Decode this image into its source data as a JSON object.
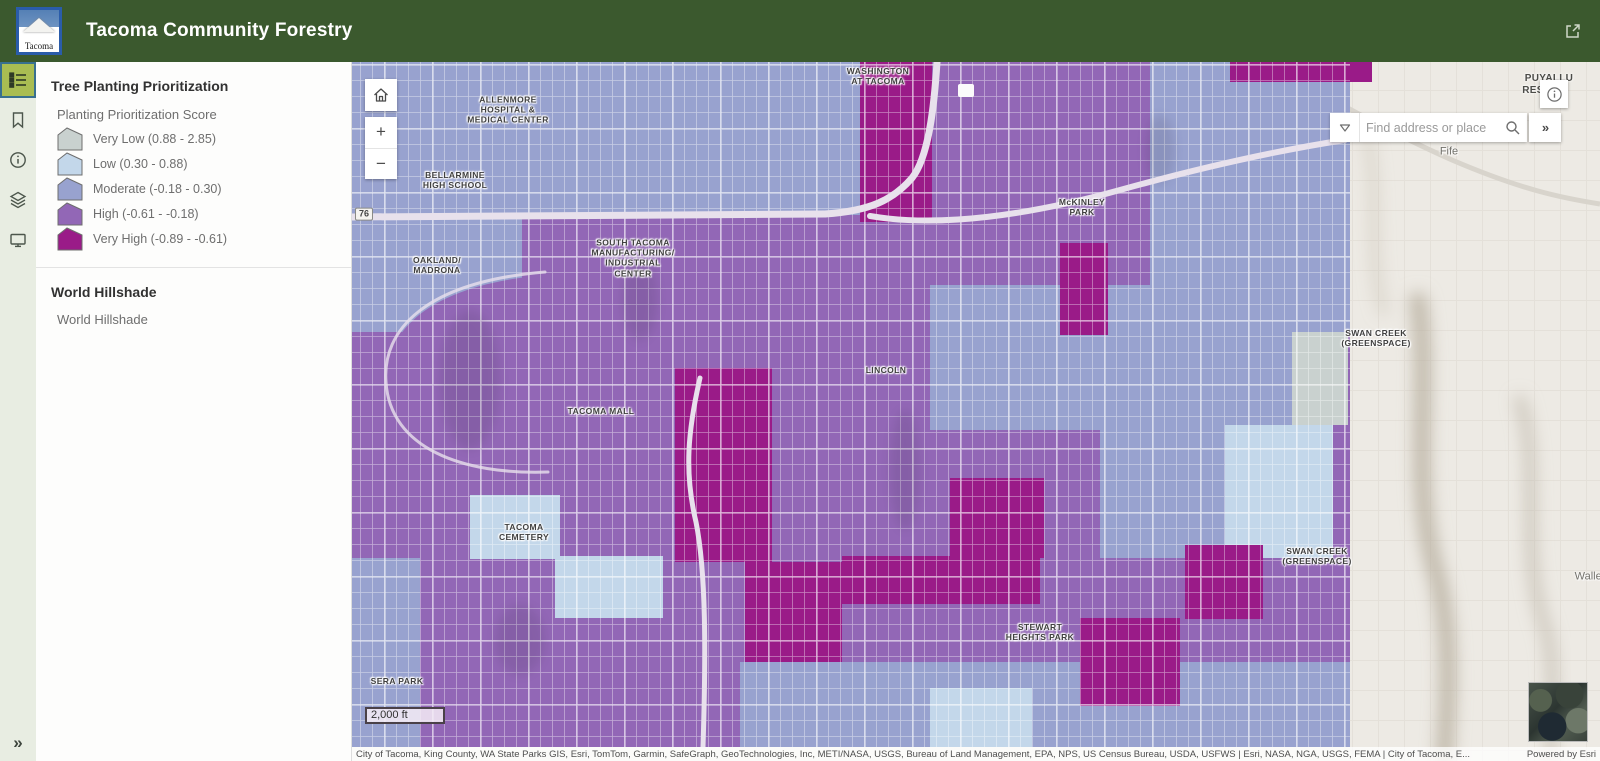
{
  "header": {
    "title": "Tacoma Community Forestry",
    "logo_text": "Tacoma"
  },
  "sidebar": {
    "items": [
      {
        "id": "legend",
        "active": true
      },
      {
        "id": "bookmarks",
        "active": false
      },
      {
        "id": "information",
        "active": false
      },
      {
        "id": "layers",
        "active": false
      },
      {
        "id": "basemap",
        "active": false
      }
    ],
    "collapse_label": "»"
  },
  "legend_panel": {
    "layer_title": "Tree Planting Prioritization",
    "field_title": "Planting Prioritization Score",
    "classes": [
      {
        "label": "Very Low (0.88 - 2.85)",
        "color": "#c9d1cf"
      },
      {
        "label": "Low (0.30 - 0.88)",
        "color": "#c3d7ea"
      },
      {
        "label": "Moderate (-0.18 - 0.30)",
        "color": "#98a2cf"
      },
      {
        "label": "High (-0.61 - -0.18)",
        "color": "#9267b6"
      },
      {
        "label": "Very High (-0.89 - -0.61)",
        "color": "#9a1b88"
      }
    ],
    "hillshade_title": "World Hillshade",
    "hillshade_item": "World Hillshade"
  },
  "map": {
    "controls": {
      "zoom_in": "+",
      "zoom_out": "−"
    },
    "search": {
      "placeholder": "Find address or place",
      "expand_label": "»"
    },
    "scalebar": "2,000 ft",
    "attribution": "City of Tacoma, King County, WA State Parks GIS, Esri, TomTom, Garmin, SafeGraph, GeoTechnologies, Inc, METI/NASA, USGS, Bureau of Land Management, EPA, NPS, US Census Bureau, USDA, USFWS | Esri, NASA, NGA, USGS, FEMA | City of Tacoma, E...",
    "powered_by": "Powered by Esri",
    "labels": [
      {
        "lines": [
          "WASHINGTON",
          "AT TACOMA"
        ],
        "x": 878,
        "y": 76,
        "kind": "poi"
      },
      {
        "lines": [
          "ALLENMORE",
          "HOSPITAL &",
          "MEDICAL CENTER"
        ],
        "x": 508,
        "y": 110,
        "kind": "poi"
      },
      {
        "lines": [
          "BELLARMINE",
          "HIGH SCHOOL"
        ],
        "x": 455,
        "y": 180,
        "kind": "poi"
      },
      {
        "lines": [
          "McKINLEY",
          "PARK"
        ],
        "x": 1082,
        "y": 207,
        "kind": "poi"
      },
      {
        "lines": [
          "OAKLAND/",
          "MADRONA"
        ],
        "x": 437,
        "y": 265,
        "kind": "poi"
      },
      {
        "lines": [
          "SOUTH TACOMA",
          "MANUFACTURING/",
          "INDUSTRIAL",
          "CENTER"
        ],
        "x": 633,
        "y": 258,
        "kind": "poi"
      },
      {
        "lines": [
          "LINCOLN"
        ],
        "x": 886,
        "y": 370,
        "kind": "poi"
      },
      {
        "lines": [
          "TACOMA MALL"
        ],
        "x": 601,
        "y": 411,
        "kind": "poi"
      },
      {
        "lines": [
          "TACOMA",
          "CEMETERY"
        ],
        "x": 524,
        "y": 532,
        "kind": "poi"
      },
      {
        "lines": [
          "SWAN CREEK",
          "(GREENSPACE)"
        ],
        "x": 1376,
        "y": 338,
        "kind": "poi"
      },
      {
        "lines": [
          "SWAN CREEK",
          "(GREENSPACE)"
        ],
        "x": 1317,
        "y": 556,
        "kind": "poi"
      },
      {
        "lines": [
          "STEWART",
          "HEIGHTS PARK"
        ],
        "x": 1040,
        "y": 632,
        "kind": "poi"
      },
      {
        "lines": [
          "SERA PARK"
        ],
        "x": 397,
        "y": 681,
        "kind": "poi"
      },
      {
        "lines": [
          "76"
        ],
        "x": 364,
        "y": 214,
        "kind": "shield"
      },
      {
        "lines": [
          "Fife"
        ],
        "x": 1449,
        "y": 152,
        "kind": "place"
      },
      {
        "lines": [
          "Waller"
        ],
        "x": 1590,
        "y": 577,
        "kind": "place"
      },
      {
        "lines": [
          "PUYALLU"
        ],
        "x": 1549,
        "y": 79,
        "kind": "place-bold"
      },
      {
        "lines": [
          "RES"
        ],
        "x": 1533,
        "y": 91,
        "kind": "place-bold"
      }
    ]
  }
}
